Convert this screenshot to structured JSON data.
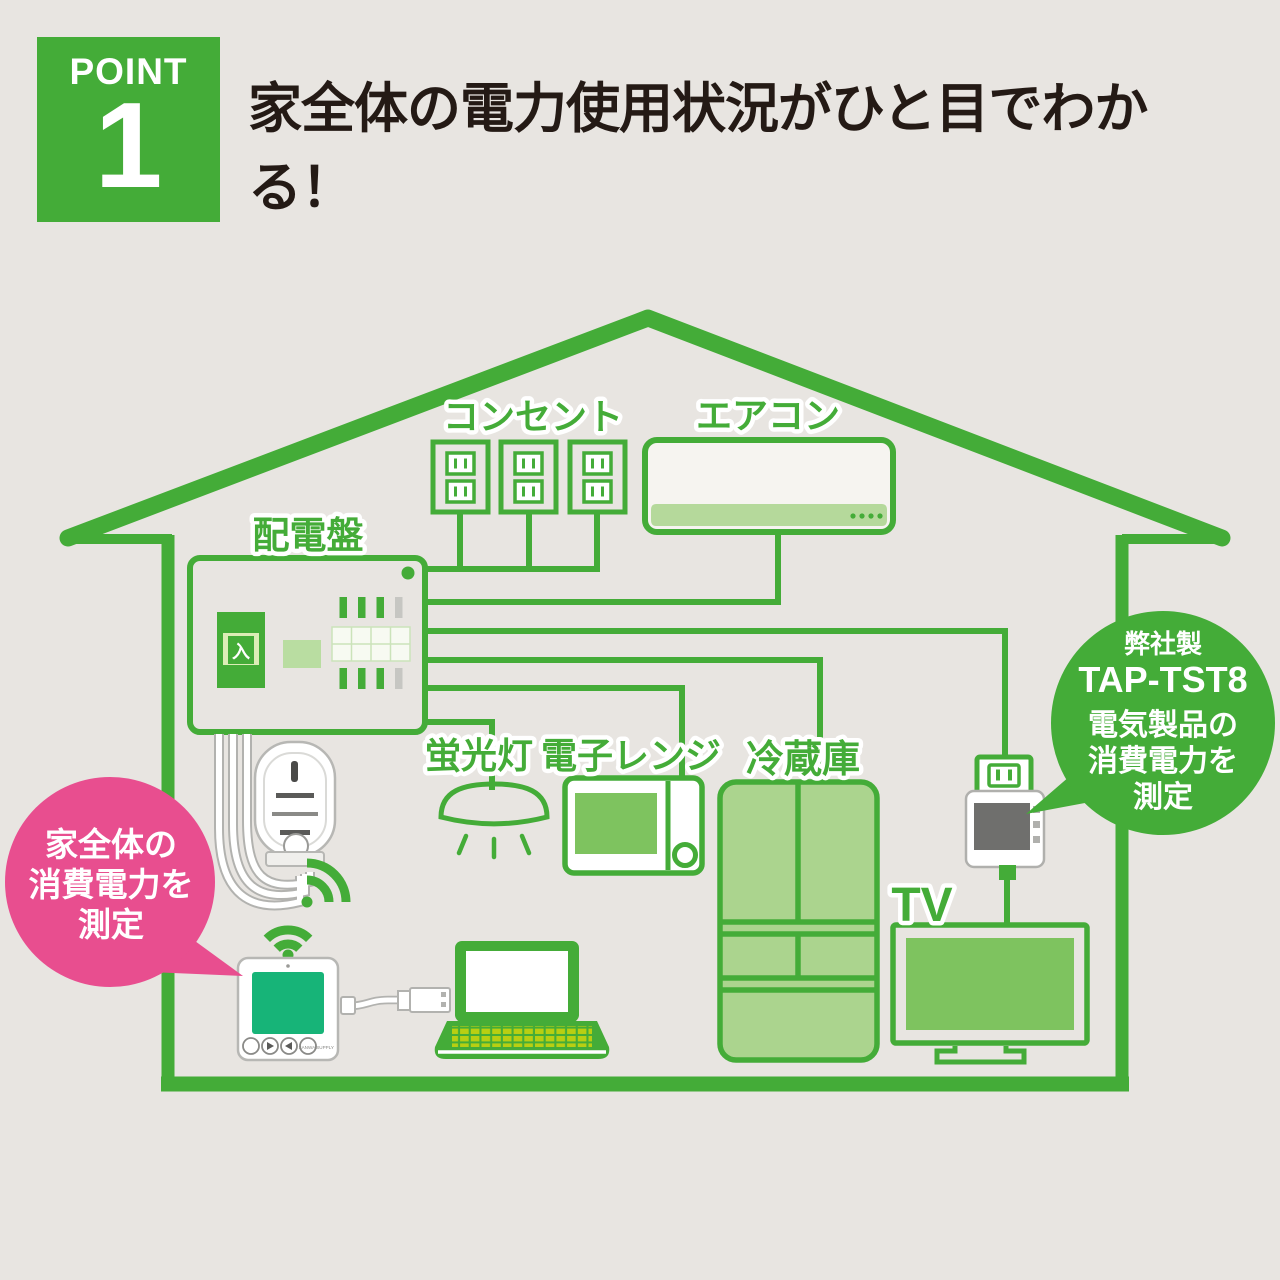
{
  "badge": {
    "label": "POINT",
    "number": "1"
  },
  "title": "家全体の電力使用状況がひと目でわかる！",
  "house": {
    "labels": {
      "outlets": "コンセント",
      "aircon": "エアコン",
      "panel": "配電盤",
      "light": "蛍光灯",
      "microwave": "電子レンジ",
      "fridge": "冷蔵庫",
      "tv": "TV"
    },
    "panel_switch": "入"
  },
  "callout_whole_house": {
    "line1": "家全体の",
    "line2": "消費電力を",
    "line3": "測定"
  },
  "callout_tap": {
    "maker": "弊社製",
    "model": "TAP-TST8",
    "line1": "電気製品の",
    "line2": "消費電力を",
    "line3": "測定"
  },
  "display_unit": {
    "brand": "SANWA SUPPLY"
  },
  "colors": {
    "green": "#44ac38",
    "green_mid": "#7ec35f",
    "green_light": "#abd48e",
    "pink": "#e84e8f",
    "screen_teal": "#17b478",
    "tap_screen_gray": "#6f6f6d",
    "background": "#e8e5e1",
    "title_black": "#241a15"
  }
}
